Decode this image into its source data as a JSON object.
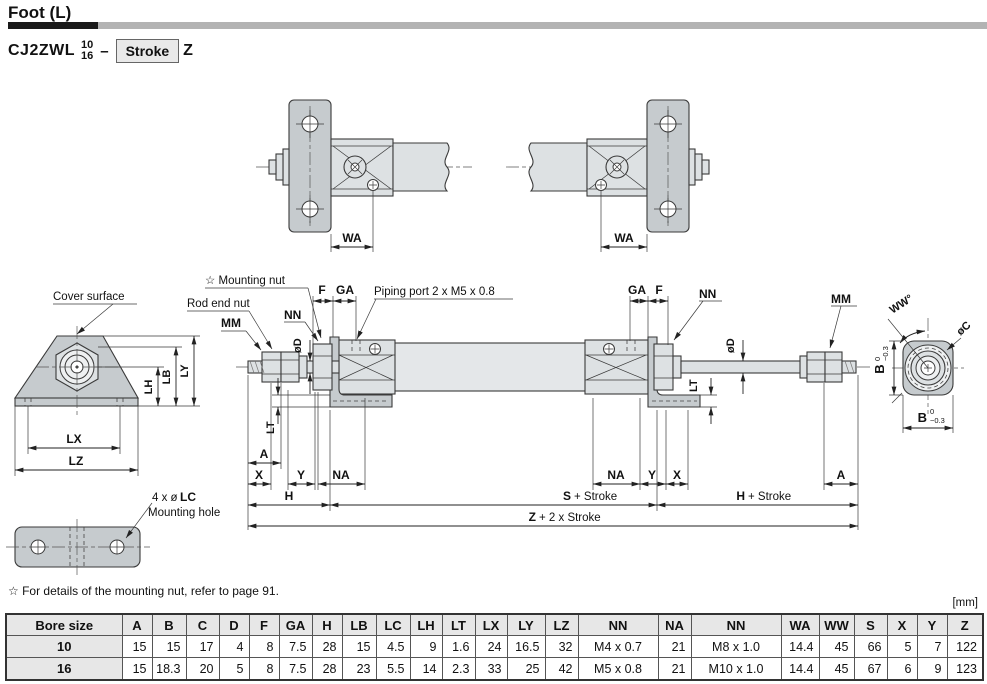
{
  "header": {
    "title": "Foot (L)",
    "model_prefix": "CJ2ZWL",
    "bore_top": "10",
    "bore_bottom": "16",
    "dash": "–",
    "stroke_label": "Stroke",
    "model_suffix": "Z"
  },
  "footnote": "☆ For details of the mounting nut, refer to page 91.",
  "unit_label": "[mm]",
  "labels": {
    "wa": "WA",
    "cover_surface": "Cover surface",
    "mounting_nut": "☆ Mounting nut",
    "rod_end_nut": "Rod end nut",
    "mm": "MM",
    "nn": "NN",
    "f": "F",
    "ga": "GA",
    "piping_port": "Piping port 2 x M5 x 0.8",
    "od": "øD",
    "lt": "LT",
    "lh": "LH",
    "lb": "LB",
    "ly": "LY",
    "lx": "LX",
    "lz": "LZ",
    "lc_prefix": "4 x ø",
    "lc_bold": "LC",
    "mounting_hole": "Mounting hole",
    "ww": "WW°",
    "oc": "øC",
    "b": "B",
    "tol_top": "0",
    "tol_bottom": "−0.3",
    "a": "A",
    "x": "X",
    "y": "Y",
    "na": "NA",
    "h": "H",
    "s": "S",
    "z": "Z",
    "plus_stroke": "+ Stroke",
    "plus_2x_stroke": "+ 2 x Stroke"
  },
  "table": {
    "headers": [
      "Bore size",
      "A",
      "B",
      "C",
      "D",
      "F",
      "GA",
      "H",
      "LB",
      "LC",
      "LH",
      "LT",
      "LX",
      "LY",
      "LZ",
      "NN",
      "NA",
      "NN",
      "WA",
      "WW",
      "S",
      "X",
      "Y",
      "Z"
    ],
    "rows": [
      {
        "bore": "10",
        "values": [
          "15",
          "15",
          "17",
          "4",
          "8",
          "7.5",
          "28",
          "15",
          "4.5",
          "9",
          "1.6",
          "24",
          "16.5",
          "32",
          "M4 x 0.7",
          "21",
          "M8 x 1.0",
          "14.4",
          "45",
          "66",
          "5",
          "7",
          "122"
        ]
      },
      {
        "bore": "16",
        "values": [
          "15",
          "18.3",
          "20",
          "5",
          "8",
          "7.5",
          "28",
          "23",
          "5.5",
          "14",
          "2.3",
          "33",
          "25",
          "42",
          "M5 x 0.8",
          "21",
          "M10 x 1.0",
          "14.4",
          "45",
          "67",
          "6",
          "9",
          "123"
        ]
      }
    ]
  }
}
